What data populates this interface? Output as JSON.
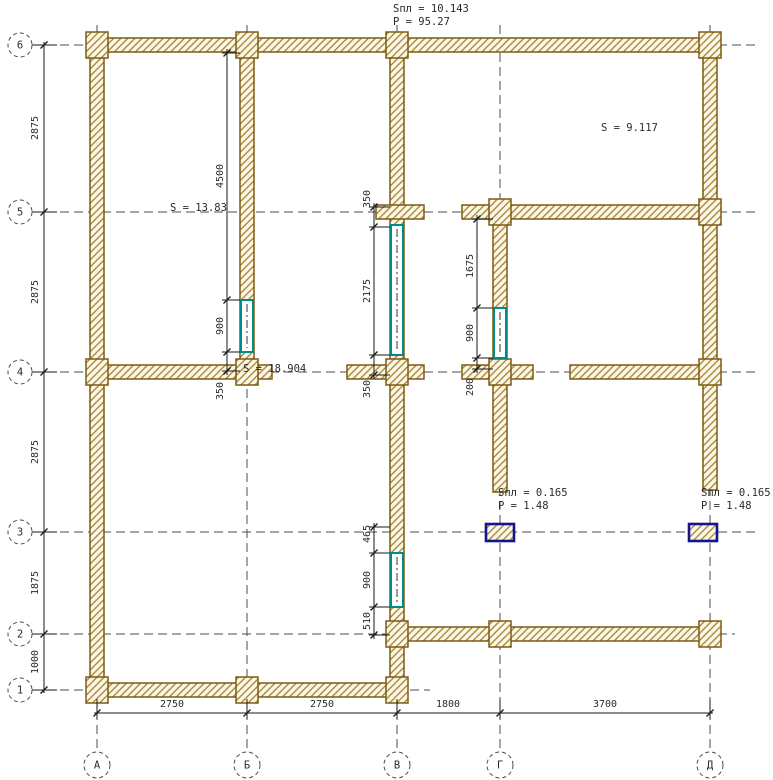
{
  "plan": {
    "colors": {
      "background": "#ffffff",
      "wall_outline": "#7d5a10",
      "wall_hatch": "#a0812c",
      "wall_fill": "#fdf7ea",
      "window": "#008b8b",
      "column_border": "#14148c",
      "axis_line": "#4d4d4d",
      "dim_line": "#1a1a1a",
      "text": "#2a2a2a"
    },
    "axes": {
      "rows": [
        {
          "label": "6",
          "y": 45,
          "line_end": 757
        },
        {
          "label": "5",
          "y": 212,
          "line_end": 757
        },
        {
          "label": "4",
          "y": 372,
          "line_end": 757
        },
        {
          "label": "3",
          "y": 532,
          "line_end": 757
        },
        {
          "label": "2",
          "y": 634,
          "line_end": 735
        },
        {
          "label": "1",
          "y": 690,
          "line_end": 430
        }
      ],
      "cols": [
        {
          "label": "А",
          "x": 97
        },
        {
          "label": "Б",
          "x": 247
        },
        {
          "label": "В",
          "x": 397
        },
        {
          "label": "Г",
          "x": 500
        },
        {
          "label": "Д",
          "x": 710
        }
      ]
    },
    "walls": [
      {
        "x": 90,
        "y": 38,
        "w": 628,
        "h": 14
      },
      {
        "x": 90,
        "y": 38,
        "w": 14,
        "h": 659
      },
      {
        "x": 240,
        "y": 38,
        "w": 14,
        "h": 345
      },
      {
        "x": 390,
        "y": 38,
        "w": 14,
        "h": 659
      },
      {
        "x": 703,
        "y": 38,
        "w": 14,
        "h": 452
      },
      {
        "x": 493,
        "y": 205,
        "w": 14,
        "h": 287
      },
      {
        "x": 462,
        "y": 205,
        "w": 256,
        "h": 14
      },
      {
        "x": 376,
        "y": 205,
        "w": 48,
        "h": 14
      },
      {
        "x": 88,
        "y": 365,
        "w": 184,
        "h": 14
      },
      {
        "x": 347,
        "y": 365,
        "w": 77,
        "h": 14
      },
      {
        "x": 462,
        "y": 365,
        "w": 71,
        "h": 14
      },
      {
        "x": 570,
        "y": 365,
        "w": 148,
        "h": 14
      },
      {
        "x": 390,
        "y": 627,
        "w": 328,
        "h": 14
      },
      {
        "x": 88,
        "y": 683,
        "w": 316,
        "h": 14
      }
    ],
    "pilasters": [
      {
        "cx": 97,
        "cy": 45
      },
      {
        "cx": 247,
        "cy": 45
      },
      {
        "cx": 397,
        "cy": 45
      },
      {
        "cx": 710,
        "cy": 45
      },
      {
        "cx": 500,
        "cy": 212
      },
      {
        "cx": 710,
        "cy": 212
      },
      {
        "cx": 97,
        "cy": 372
      },
      {
        "cx": 247,
        "cy": 372
      },
      {
        "cx": 397,
        "cy": 372
      },
      {
        "cx": 500,
        "cy": 372
      },
      {
        "cx": 710,
        "cy": 372
      },
      {
        "cx": 397,
        "cy": 634
      },
      {
        "cx": 500,
        "cy": 634
      },
      {
        "cx": 710,
        "cy": 634
      },
      {
        "cx": 97,
        "cy": 690
      },
      {
        "cx": 247,
        "cy": 690
      },
      {
        "cx": 397,
        "cy": 690
      }
    ],
    "windows": [
      {
        "x": 241,
        "y": 300,
        "w": 12,
        "h": 52
      },
      {
        "x": 391,
        "y": 225,
        "w": 12,
        "h": 130
      },
      {
        "x": 494,
        "y": 308,
        "w": 12,
        "h": 50
      },
      {
        "x": 391,
        "y": 553,
        "w": 12,
        "h": 54
      }
    ],
    "columns": [
      {
        "x": 486,
        "y": 524,
        "w": 28,
        "h": 17
      },
      {
        "x": 689,
        "y": 524,
        "w": 28,
        "h": 17
      }
    ],
    "dim_groups": [
      {
        "x": 227,
        "wall_x": 240,
        "ticks": [
          53,
          300,
          352,
          371
        ],
        "labels": [
          {
            "text": "4500",
            "y": 176
          },
          {
            "text": "900",
            "y": 326
          },
          {
            "text": "350",
            "y": 391
          }
        ]
      },
      {
        "x": 374,
        "wall_x": 390,
        "ticks": [
          207,
          227,
          355,
          375
        ],
        "labels": [
          {
            "text": "350",
            "y": 199
          },
          {
            "text": "2175",
            "y": 291
          },
          {
            "text": "350",
            "y": 389
          }
        ]
      },
      {
        "x": 477,
        "wall_x": 493,
        "ticks": [
          219,
          308,
          358,
          369
        ],
        "labels": [
          {
            "text": "1675",
            "y": 266
          },
          {
            "text": "900",
            "y": 333
          },
          {
            "text": "200",
            "y": 387
          }
        ]
      },
      {
        "x": 374,
        "wall_x": 390,
        "ticks": [
          527,
          553,
          607,
          635
        ],
        "labels": [
          {
            "text": "465",
            "y": 534
          },
          {
            "text": "900",
            "y": 580
          },
          {
            "text": "510",
            "y": 621
          }
        ]
      }
    ],
    "left_dim": {
      "x": 44,
      "ticks": [
        45,
        212,
        372,
        532,
        634,
        690
      ],
      "labels": [
        {
          "text": "2875",
          "y": 128
        },
        {
          "text": "2875",
          "y": 292
        },
        {
          "text": "2875",
          "y": 452
        },
        {
          "text": "1875",
          "y": 583
        },
        {
          "text": "1000",
          "y": 662
        }
      ]
    },
    "bottom_dim": {
      "y": 713,
      "ticks": [
        97,
        247,
        397,
        500,
        710
      ],
      "labels": [
        {
          "text": "2750",
          "x": 172
        },
        {
          "text": "2750",
          "x": 322
        },
        {
          "text": "1800",
          "x": 448
        },
        {
          "text": "3700",
          "x": 605
        }
      ]
    },
    "annotations": [
      {
        "text": "Sпл = 10.143",
        "x": 393,
        "y": 12
      },
      {
        "text": "P   = 95.27",
        "x": 393,
        "y": 25
      },
      {
        "text": "S    = 9.117",
        "x": 601,
        "y": 131
      },
      {
        "text": "S    = 13.83",
        "x": 170,
        "y": 211
      },
      {
        "text": "S  = 18.904",
        "x": 243,
        "y": 372
      },
      {
        "text": "Sпл = 0.165",
        "x": 498,
        "y": 496
      },
      {
        "text": "P   = 1.48",
        "x": 498,
        "y": 509
      },
      {
        "text": "Sпл = 0.165",
        "x": 701,
        "y": 496
      },
      {
        "text": "P   = 1.48",
        "x": 701,
        "y": 509
      }
    ]
  }
}
